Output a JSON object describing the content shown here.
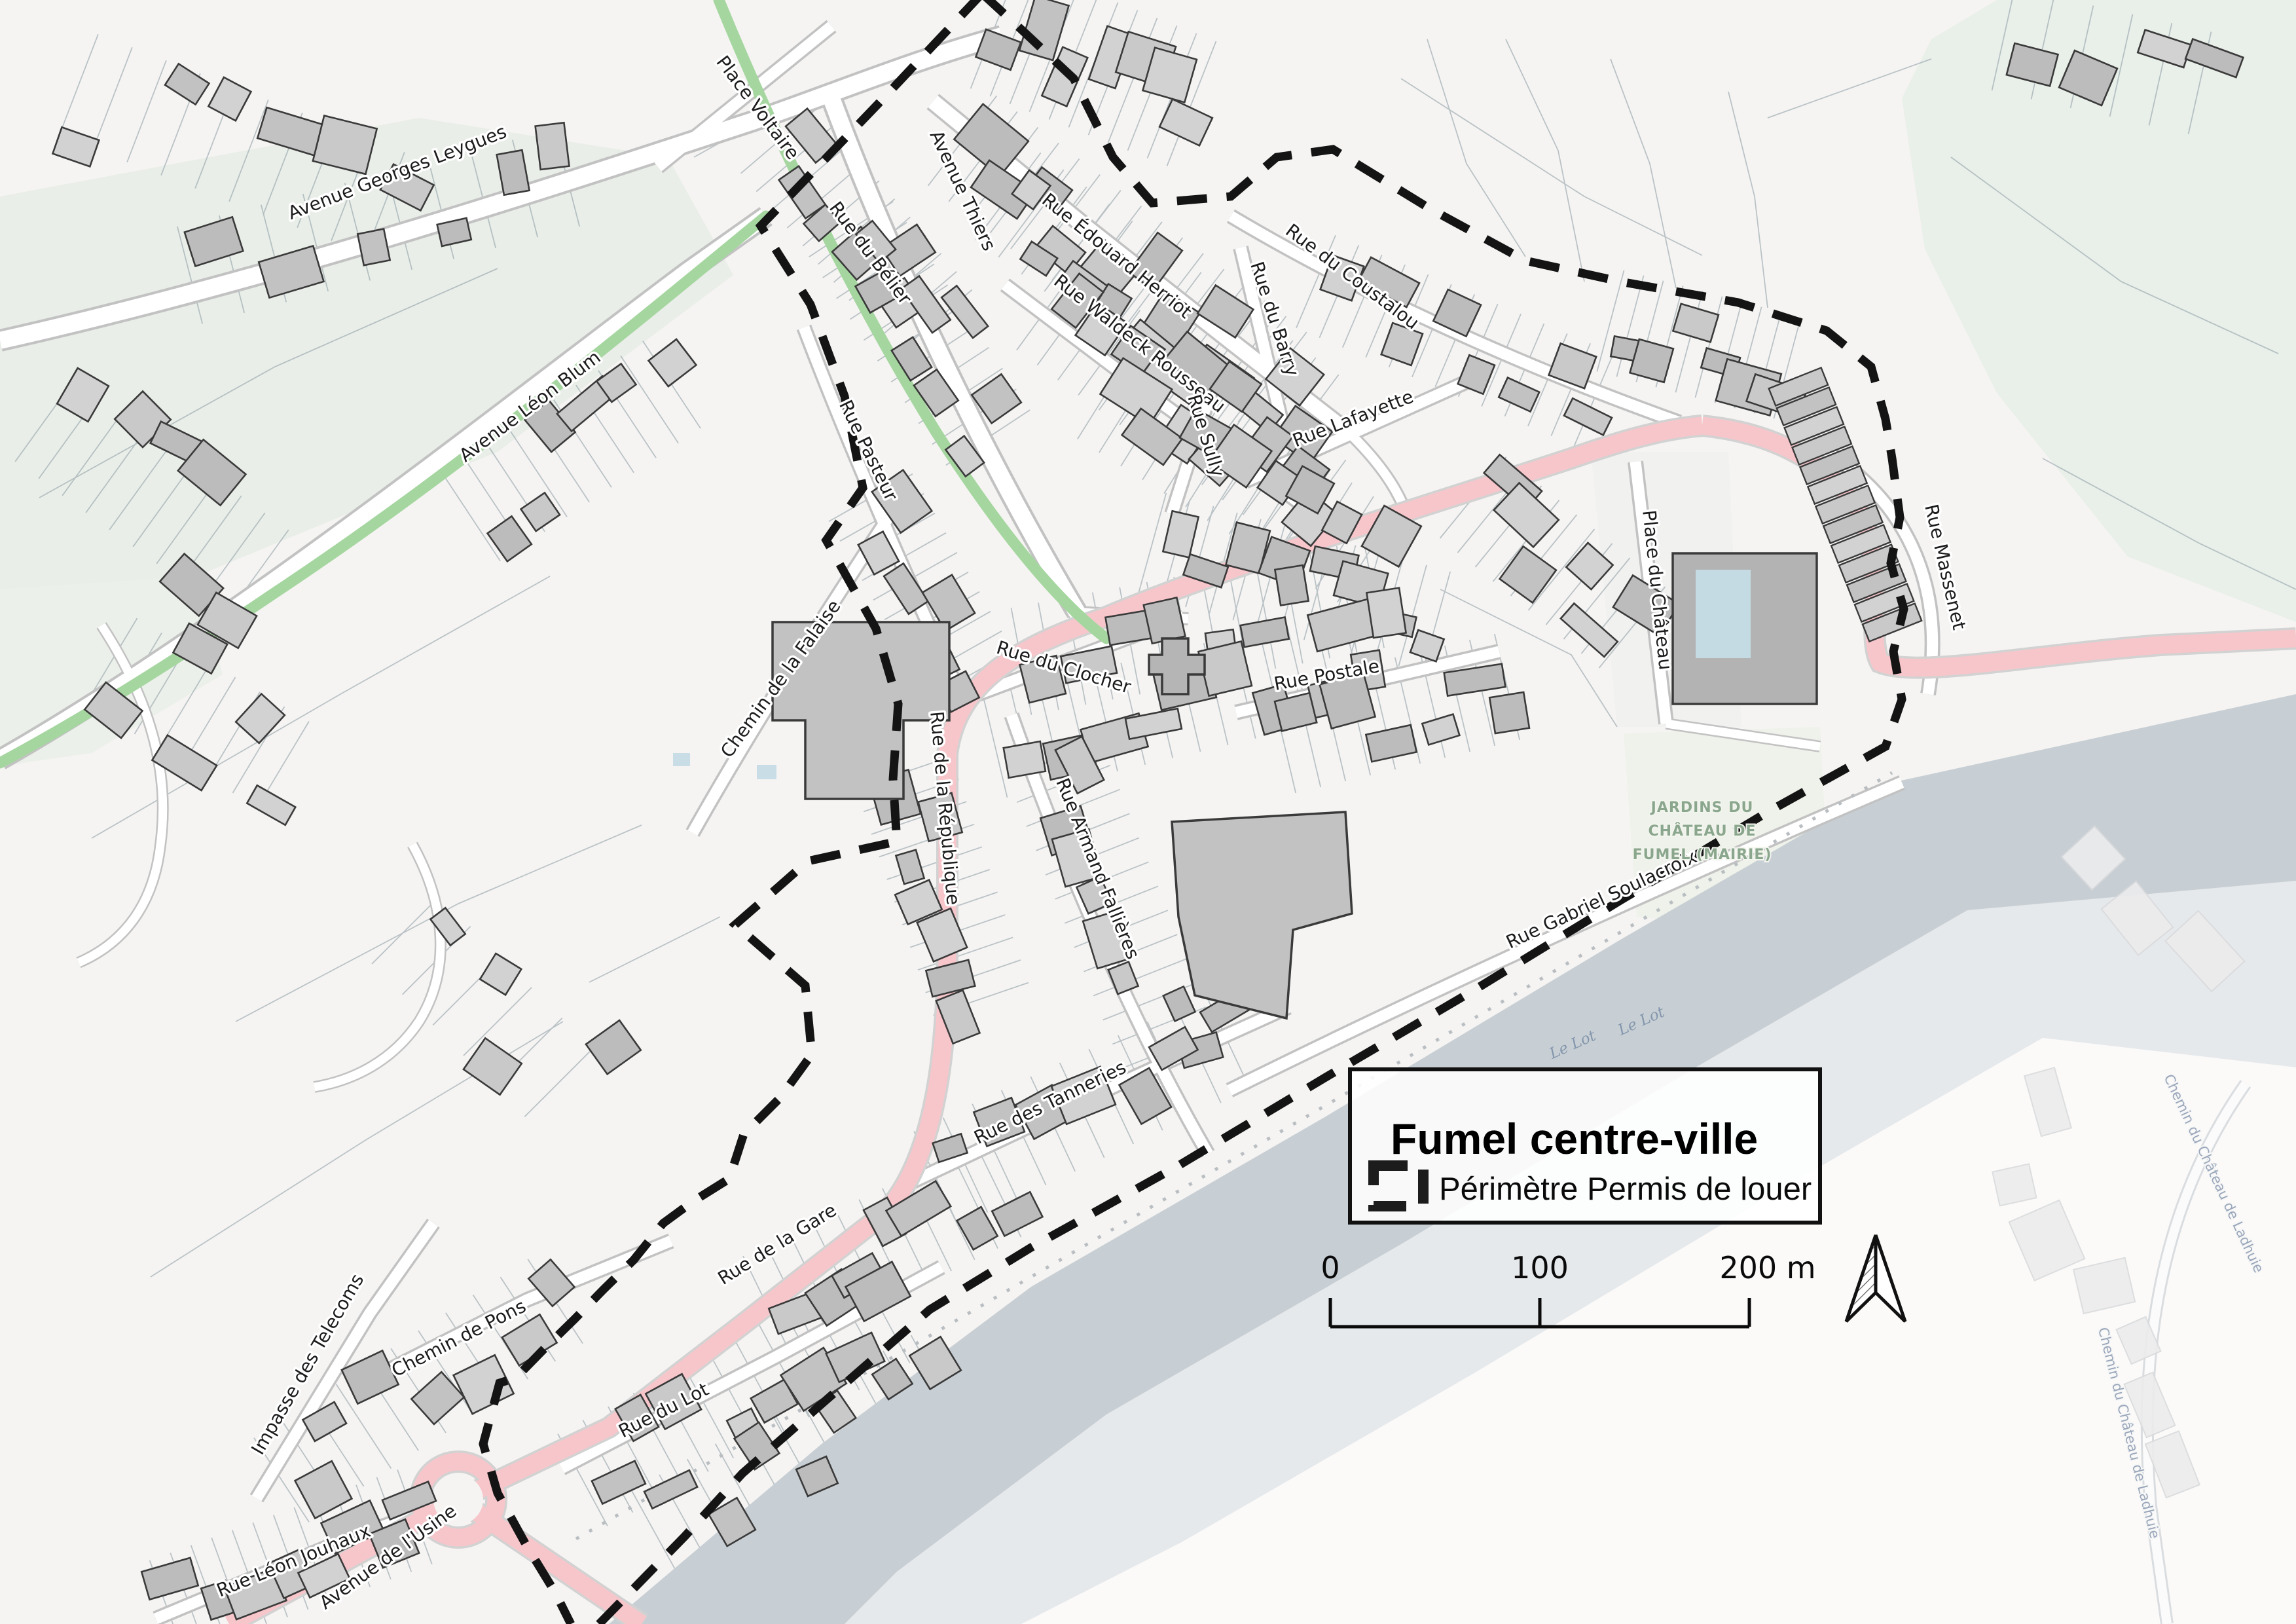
{
  "legend": {
    "title": "Fumel centre-ville",
    "item_label": "Périmètre Permis de louer",
    "symbol": "dashed-perimeter-rectangle"
  },
  "scale_bar": {
    "labels": [
      "0",
      "100",
      "200 m"
    ]
  },
  "icons": {
    "north_arrow": "north-arrow"
  },
  "streets": [
    {
      "name": "Avenue Georges Leygues"
    },
    {
      "name": "Place Voltaire"
    },
    {
      "name": "Avenue Thiers"
    },
    {
      "name": "Rue du Bélier"
    },
    {
      "name": "Rue Édouard Herriot"
    },
    {
      "name": "Rue du Coustalou"
    },
    {
      "name": "Avenue Léon Blum"
    },
    {
      "name": "Rue Waldeck Rousseau"
    },
    {
      "name": "Rue du Barry"
    },
    {
      "name": "Rue Sully"
    },
    {
      "name": "Rue Lafayette"
    },
    {
      "name": "Rue Pasteur"
    },
    {
      "name": "Place du Château"
    },
    {
      "name": "Rue Massenet"
    },
    {
      "name": "Chemin de la Falaise"
    },
    {
      "name": "Rue du Clocher"
    },
    {
      "name": "Rue Postale"
    },
    {
      "name": "Rue de la République"
    },
    {
      "name": "Rue Armand Fallières"
    },
    {
      "name": "Rue Gabriel Soulacroix"
    },
    {
      "name": "Rue des Tanneries"
    },
    {
      "name": "Rue de la Gare"
    },
    {
      "name": "Chemin de Pons"
    },
    {
      "name": "Impasse des Telecoms"
    },
    {
      "name": "Rue du Lot"
    },
    {
      "name": "Rue Léon Jouhaux"
    },
    {
      "name": "Avenue de l'Usine"
    }
  ],
  "places": {
    "jardins_lines": [
      "JARDINS DU",
      "CHÂTEAU DE",
      "FUMEL (MAIRIE)"
    ]
  },
  "water": {
    "river_label": "Le Lot"
  },
  "outside": {
    "road_label": "Chemin du Château de Ladhuie"
  },
  "colors": {
    "perimeter": "#141414",
    "main_road_pink": "#f7c6cb",
    "path_green": "#a6d6a0",
    "river": "#c8cfd4",
    "building_fill": "#c9c9c9",
    "building_outline": "#3a3a3a",
    "parcel_line": "#93a2aa",
    "land": "#f5f4f2",
    "field_green": "#e9eee8"
  }
}
